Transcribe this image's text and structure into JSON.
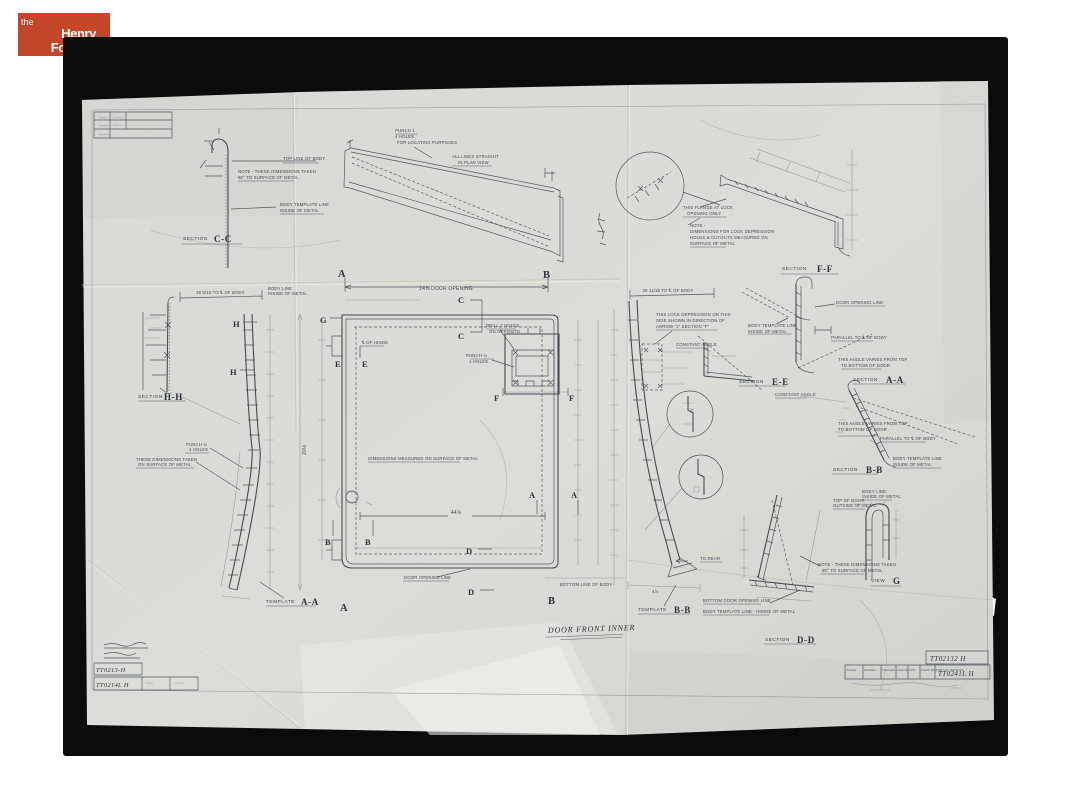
{
  "logo": {
    "the": "the",
    "henry": "Henry",
    "ford": "Ford"
  },
  "colors": {
    "logo_bg": "#c4452a",
    "paper": "#d8d8d4",
    "photo": "#0b0b0b",
    "ink": "#39424b"
  },
  "sheet": {
    "title": "DOOR FRONT INNER",
    "words": {
      "section": "SECTION",
      "template": "TEMPLATE",
      "view": "VIEW"
    },
    "sections": {
      "cc": "C-C",
      "ff": "F-F",
      "hh": "H-H",
      "aa": "A-A",
      "bb": "B-B",
      "ee": "E-E",
      "dd": "D-D",
      "g": "G"
    },
    "letters": {
      "a": "A",
      "b": "B",
      "c": "C",
      "d": "D",
      "e": "E",
      "f": "F",
      "g": "G",
      "h": "H"
    },
    "notes": {
      "note90_1": "NOTE - THESE DIMENSIONS TAKEN",
      "note90_2": "90° TO SURFACE OF METAL",
      "top_line_body": "TOP LINE OF BODY",
      "body_template_1": "BODY TEMPLATE LINE",
      "body_template_2": "INSIDE OF METAL",
      "punch1_1": "PUNCH 1",
      "punch1_2": "4 HOLES",
      "punch1_3": "FOR LOCATING PURPOSES",
      "straight_1": "ALL LINES STRAIGHT",
      "straight_2": "IN PLAN VIEW",
      "flange_1": "THIS FLANGE AT LOCK",
      "flange_2": "OPENING ONLY",
      "lockdim_1": "NOTE -",
      "lockdim_2": "DIMENSIONS FOR LOCK DEPRESSION",
      "lockdim_3": "HOLES & CUTOUTS MEASURED ON",
      "lockdim_4": "SURFACE OF METAL",
      "body_line_1": "BODY LINE",
      "body_line_2": "INSIDE OF METAL",
      "punch18_1": "PUNCH ⅛",
      "punch18_2": "4 HOLES",
      "surface_1": "THESE DIMENSIONS TAKEN",
      "surface_2": "ON SURFACE OF METAL",
      "dims_measured": "DIMENSIONS MEASURED ON SURFACE OF METAL",
      "cl_hinge": "℄ OF HINGE",
      "drill2_1": "DRILL 2 HOLES",
      "drill2_2": "ON OPPOSITE",
      "punch14_1": "PUNCH ¼",
      "punch14_2": "4 HOLES",
      "door_opening_line": "DOOR OPENING LINE",
      "lock_note_1": "THIS LOCK DEPRESSION ON THIS",
      "lock_note_2": "SIDE SHOWN IN DIRECTION OF",
      "lock_note_3": "ARROW \"J\" SECTION \"F\"",
      "constant_angle": "CONSTANT ANGLE",
      "parallel_cl": "PARALLEL TO ℄ OF BODY",
      "angle_varies_1": "THIS ANGLE VARIES FROM TOP",
      "angle_varies_2": "TO BOTTOM OF DOOR",
      "top_of_door_1": "TOP OF DOOR",
      "top_of_door_2": "OUTSIDE OF METAL",
      "bottom_door_opening": "BOTTOM DOOR OPENING LINE",
      "body_template_dash": "BODY TEMPLATE LINE - INSIDE OF METAL",
      "bottom_line_body": "BOTTOM LINE OF BODY",
      "to_rear": "TO REAR"
    },
    "dims": {
      "door_opening": "14⅞ DOOR OPENING",
      "d18": "18 5/16 TO ℄ OF BODY",
      "d28": "28 11/16 TO ℄ OF BODY",
      "d44": "44⅞",
      "d20": "20½",
      "d478": "4⅞"
    },
    "blocks": {
      "left": {
        "num1": "TT0213-H",
        "num2": "TT0214L H"
      },
      "right": {
        "num1": "TT02132 H",
        "num2": "TT0241L H",
        "cells": [
          "SCALE",
          "DRAWN",
          "TRACED",
          "CHECK",
          "APP.",
          "FORD MOTOR CO. DETROIT"
        ]
      }
    }
  }
}
